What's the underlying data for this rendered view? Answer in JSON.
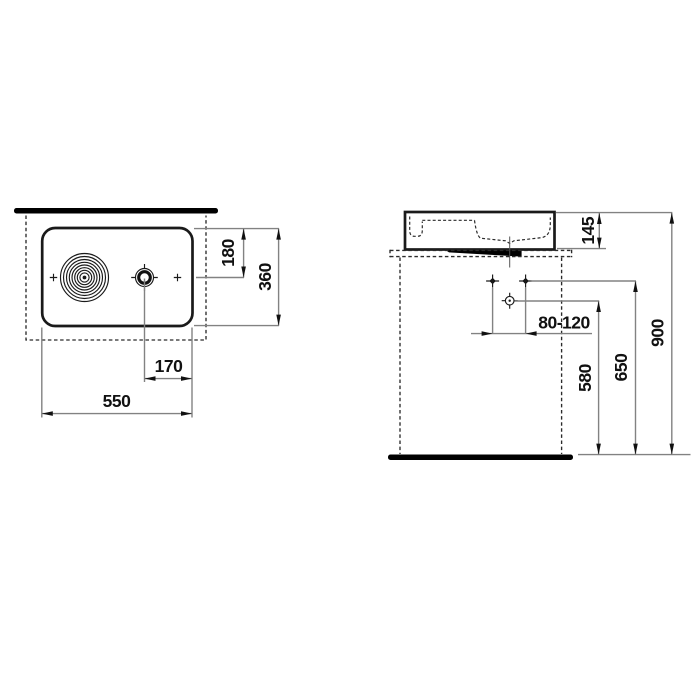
{
  "title": "Washbasin technical dimension drawing",
  "colors": {
    "object_line": "#1a1a1a",
    "dim_line": "#828282",
    "text": "#111111",
    "dashed_line": "#2b2b2b",
    "solid_fill": "#000000",
    "background": "#ffffff"
  },
  "views": {
    "top": {
      "name": "top view",
      "dims": {
        "width": "550",
        "depth": "360",
        "tap_axis_from_front": "180",
        "tap_to_edge": "170"
      }
    },
    "front": {
      "name": "front elevation",
      "dims": {
        "basin_height": "145",
        "supply_spacing": "80-120",
        "drain_height": "580",
        "supply_height": "650",
        "rim_height": "900"
      }
    }
  }
}
